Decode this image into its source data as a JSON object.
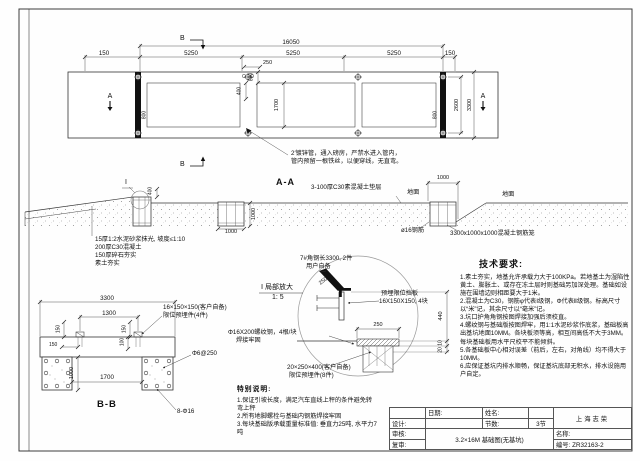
{
  "plan": {
    "dim_overall": "16050",
    "dim_150_left": "150",
    "dim_5250_1": "5250",
    "dim_5250_2": "5250",
    "dim_5250_3": "5250",
    "dim_150_right": "150",
    "dim_800_top": "800",
    "dim_250": "250",
    "dim_400": "400",
    "dim_1700": "1700",
    "dim_2600": "2600",
    "dim_3300": "3300",
    "dim_800_left_bar": "800",
    "dim_800_right_bar": "800",
    "marker_a_left": "A",
    "marker_a_right": "A",
    "marker_b_top": "B",
    "marker_b_bottom": "B",
    "pipe_note_line1": "2′镀锌管，通入磅房，严禁水进入管内，",
    "pipe_note_line2": "管内预留一根铁丝，以便穿线，无直弯。"
  },
  "section_aa": {
    "title": "A-A",
    "cushion_label": "3-100厚C30素混凝土垫层",
    "ground_left": "地面",
    "ground_right": "地面",
    "rebar_label": "ø16钢筋",
    "cage_label": "3300x1000x1000混凝土钢筋笼",
    "dim_1000_pit": "1000",
    "dim_1000_w": "1000",
    "dim_1000_h": "1000",
    "dim_400": "400",
    "detail_flag": "I",
    "layer_line1": "15厚1:2水泥砂浆抹光, 坡度≤1:10",
    "layer_line2": "200厚C30混凝土",
    "layer_line3": "150厚碎石夯实",
    "layer_line4": "素土夯实"
  },
  "detail": {
    "angle_line1": "7#角钢长3300, 2件",
    "angle_line2": "用户自备",
    "title_line1": "Ⅰ 局部放大",
    "title_line2": "1: 5",
    "baffle_line1": "预埋限位挡板",
    "baffle_line2": "16X150X150, 4块",
    "rebar_line1": "Φ16X200螺纹钢，4根/块",
    "rebar_line2": "焊接牢固",
    "embed_line1": "20×250×400(客户自备)",
    "embed_line2": "限位预埋件(8件)",
    "dim_250_slant": "250",
    "dim_250": "250",
    "dim_440": "440",
    "dim_10": "10",
    "dim_20": "20"
  },
  "section_bb": {
    "title": "B-B",
    "dim_3300": "3300",
    "dim_1300": "1300",
    "dim_150_left": "150",
    "dim_150_right": "150",
    "dim_150_h": "150",
    "dim_100": "100",
    "dim_1000": "1000",
    "dim_1700": "1700",
    "limit_line1": "16×150×150(客户自备)",
    "limit_line2": "限位预埋件(4件)",
    "stirrup_label": "Φ6@250",
    "bars_label": "8-Φ16"
  },
  "special_notes": {
    "title": "特别说明:",
    "item1": "1.保证引坡长度，满足汽车直线上秤的条件避免转弯上秤",
    "item2": "2.所有地脚螺栓与基础内钢筋焊接牢固",
    "item3": "3.每块基础版承载重量标准值: 垂直力25吨, 水平力7吨"
  },
  "tech_requirements": {
    "title": "技术要求:",
    "item1": "1.素土夯实，地基允许承载力大于100KPa。若地基土为湿陷性黄土、膨胀土、或存在冻土层时则基础另加深处理。基础如设施在围墙边则相距要大于1米。",
    "item2": "2.混凝土为C30，钢筋φ代表Ⅰ级钢，Φ代表Ⅱ级钢。标高尺寸以“米”记，其余尺寸以“毫米”记。",
    "item3": "3.坑口护角角钢按图焊接加强后须校直。",
    "item4": "4.螺纹钢与基础版按图焊牢，用1:1水泥砂浆作底浆，基础板高出基坑地面10MM。各块板须等高，相互间高低不大于3MM。每块基础板用水平尺校平不能倾斜。",
    "item5": "5.各基础板中心相对误差（前后，左右，对角线）均不得大于10MM。",
    "item6": "6.应保证基坑内排水顺畅，保证基坑底部无积水，排水设施用户自定。"
  },
  "title_block": {
    "date_label": "日期:",
    "name_label": "姓名:",
    "design_label": "设计:",
    "sections_label": "节数:",
    "sections_value": "3节",
    "review_label": "审核:",
    "recheck_label": "复审:",
    "drawing_title": "3.2×16M 基础图(无基坑)",
    "company": "上海志荣",
    "title_label": "名称:",
    "number_label": "编号: ZR32163-2"
  }
}
